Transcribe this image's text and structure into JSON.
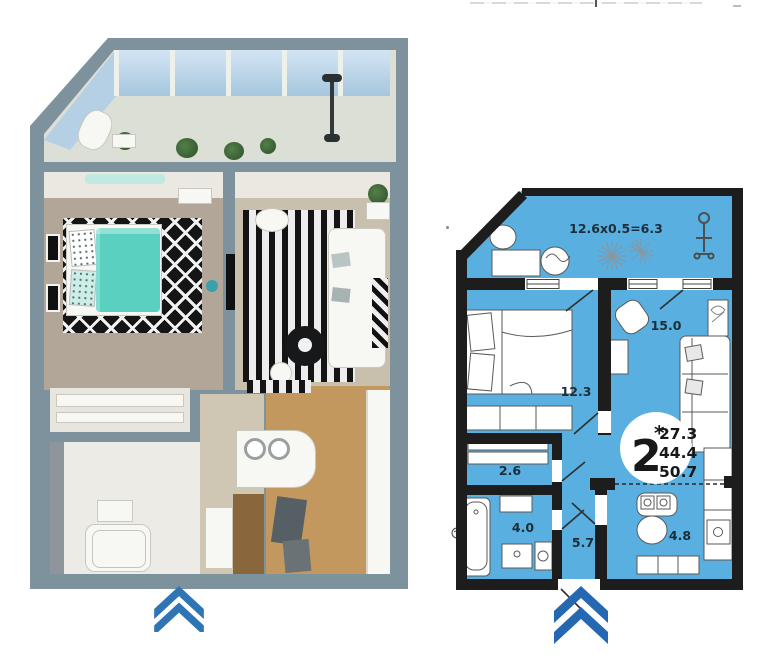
{
  "plan2d": {
    "balcony_formula": "12.6x0.5=6.3",
    "rooms": [
      {
        "name": "living-room",
        "area": "15.0"
      },
      {
        "name": "bedroom",
        "area": "12.3"
      },
      {
        "name": "closet",
        "area": "2.6"
      },
      {
        "name": "bathroom",
        "area": "4.0"
      },
      {
        "name": "hallway",
        "area": "5.7"
      },
      {
        "name": "kitchen",
        "area": "4.8"
      }
    ],
    "summary": {
      "rooms_count": "2",
      "asterisk": "*",
      "living_area": "27.3",
      "apartment_area": "44.4",
      "total_area": "50.7"
    }
  },
  "colors": {
    "plan_fill": "#58afe0",
    "wall": "#1d1d1d",
    "arrow": "#2368b1",
    "wall_3d": "#7e929e",
    "bed_accent": "#5ad0c0"
  }
}
